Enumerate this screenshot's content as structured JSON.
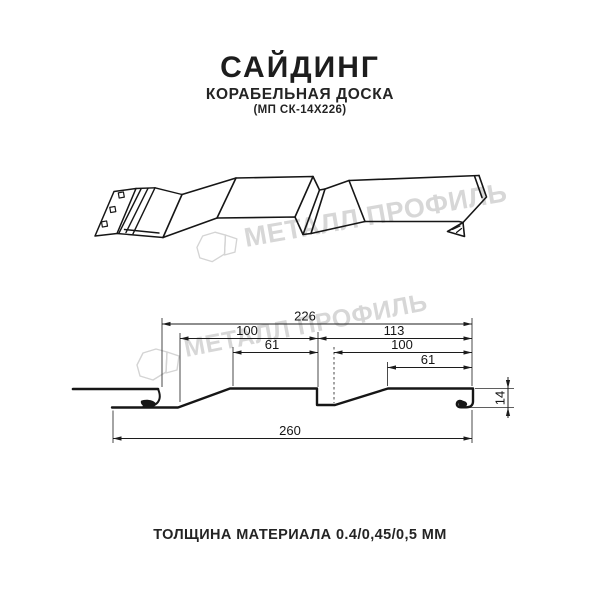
{
  "header": {
    "title": "САЙДИНГ",
    "subtitle": "КОРАБЕЛЬНАЯ ДОСКА",
    "product_code": "(МП СК-14Х226)"
  },
  "footer": {
    "thickness_label": "ТОЛЩИНА МАТЕРИАЛА 0.4/0,45/0,5 ММ"
  },
  "watermark": {
    "text": "МЕТАЛЛ ПРОФИЛЬ",
    "color": "#d7d7d7"
  },
  "colors": {
    "background": "#ffffff",
    "line_art": "#161616",
    "dimension_lines": "#1c1c1c"
  },
  "diagram": {
    "type": "siding-profile-technical-drawing",
    "views": [
      "3d-perspective-panel",
      "cross-section-with-dimensions"
    ],
    "dim_labels": {
      "d226": "226",
      "d100_left": "100",
      "d113": "113",
      "d61_left": "61",
      "d100_right": "100",
      "d61_right": "61",
      "d260": "260",
      "d14": "14"
    },
    "dimensions_mm": [
      {
        "name": "coverage-width",
        "value": 226
      },
      {
        "name": "left-board-width",
        "value": 100
      },
      {
        "name": "right-board-width",
        "value": 113
      },
      {
        "name": "left-board-flat",
        "value": 61
      },
      {
        "name": "right-board-inner-width",
        "value": 100
      },
      {
        "name": "right-board-flat",
        "value": 61
      },
      {
        "name": "total-width",
        "value": 260
      },
      {
        "name": "profile-height",
        "value": 14
      }
    ]
  }
}
